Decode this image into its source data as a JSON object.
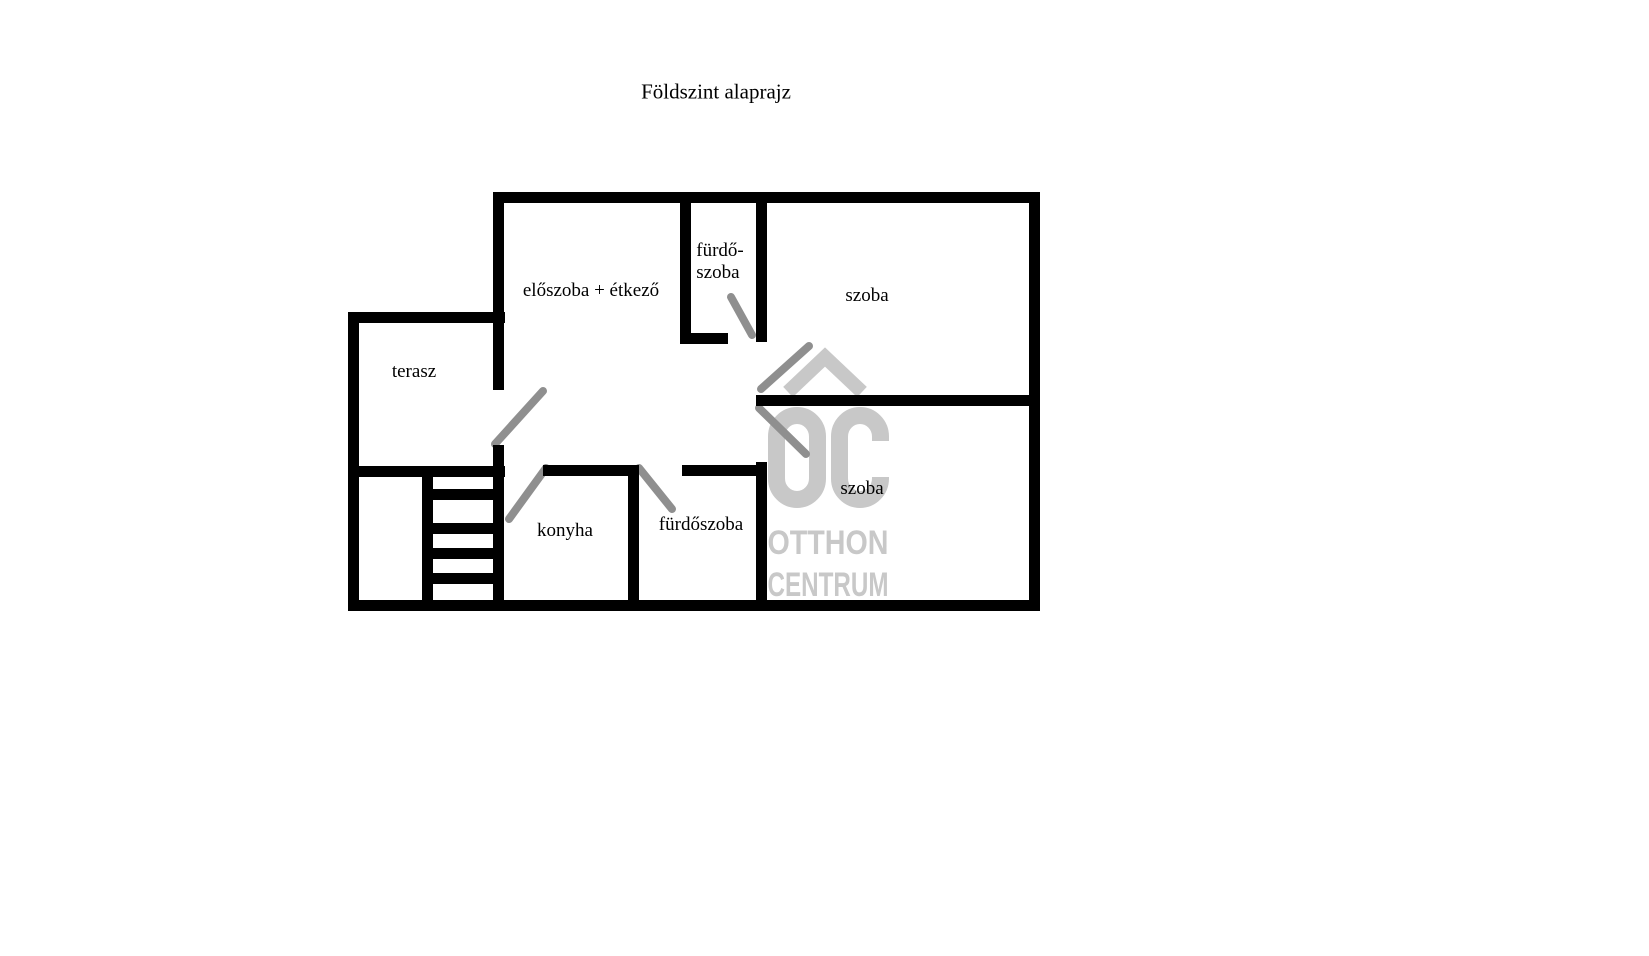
{
  "page": {
    "width": 1649,
    "height": 956,
    "background": "#ffffff"
  },
  "title": {
    "text": "Földszint alaprajz"
  },
  "floorplan": {
    "colors": {
      "wall": "#000000",
      "door": "#8f8f8f",
      "watermark": "#c8c8c8",
      "label": "#000000"
    },
    "labels": [
      {
        "id": "eloszoba-etkezo",
        "text": "előszoba + étkező",
        "cx": 591,
        "cy": 291
      },
      {
        "id": "furdoszoba-top",
        "text": "fürdő-\nszoba",
        "cx": 720,
        "cy": 262
      },
      {
        "id": "szoba-top",
        "text": "szoba",
        "cx": 867,
        "cy": 296
      },
      {
        "id": "terasz",
        "text": "terasz",
        "cx": 414,
        "cy": 372
      },
      {
        "id": "konyha",
        "text": "konyha",
        "cx": 565,
        "cy": 531
      },
      {
        "id": "furdoszoba-bottom",
        "text": "fürdőszoba",
        "cx": 701,
        "cy": 525
      },
      {
        "id": "szoba-bottom",
        "text": "szoba",
        "cx": 862,
        "cy": 489
      }
    ],
    "walls": [
      {
        "id": "top",
        "x": 493,
        "y": 192,
        "w": 547,
        "h": 11
      },
      {
        "id": "right",
        "x": 1029,
        "y": 192,
        "w": 11,
        "h": 419
      },
      {
        "id": "bottom",
        "x": 348,
        "y": 600,
        "w": 692,
        "h": 11
      },
      {
        "id": "outer-left",
        "x": 348,
        "y": 312,
        "w": 11,
        "h": 299
      },
      {
        "id": "terasz-top",
        "x": 348,
        "y": 312,
        "w": 157,
        "h": 11
      },
      {
        "id": "terasz-bottom",
        "x": 348,
        "y": 466,
        "w": 157,
        "h": 11
      },
      {
        "id": "hall-left-upper",
        "x": 493,
        "y": 192,
        "w": 11,
        "h": 198
      },
      {
        "id": "hall-left-lower",
        "x": 493,
        "y": 445,
        "w": 11,
        "h": 166
      },
      {
        "id": "stairs-left-rail",
        "x": 422,
        "y": 466,
        "w": 11,
        "h": 145
      },
      {
        "id": "konyha-top",
        "x": 543,
        "y": 465,
        "w": 96,
        "h": 11
      },
      {
        "id": "konyha-right",
        "x": 628,
        "y": 465,
        "w": 11,
        "h": 146
      },
      {
        "id": "bath-bottom-top",
        "x": 682,
        "y": 465,
        "w": 85,
        "h": 11
      },
      {
        "id": "bath-bottom-right",
        "x": 756,
        "y": 462,
        "w": 11,
        "h": 149
      },
      {
        "id": "bath-top-left",
        "x": 680,
        "y": 192,
        "w": 11,
        "h": 152
      },
      {
        "id": "bath-top-bottom",
        "x": 680,
        "y": 333,
        "w": 48,
        "h": 11
      },
      {
        "id": "bath-top-right",
        "x": 756,
        "y": 192,
        "w": 11,
        "h": 150
      },
      {
        "id": "middle",
        "x": 756,
        "y": 395,
        "w": 284,
        "h": 11
      }
    ],
    "stairs": {
      "treads": [
        {
          "x": 433,
          "y": 489,
          "w": 60,
          "h": 11
        },
        {
          "x": 433,
          "y": 523,
          "w": 60,
          "h": 11
        },
        {
          "x": 433,
          "y": 548,
          "w": 60,
          "h": 11
        },
        {
          "x": 433,
          "y": 573,
          "w": 60,
          "h": 11
        }
      ]
    },
    "doors": [
      {
        "id": "terasz-door",
        "x1": 495,
        "y1": 444,
        "x2": 543,
        "y2": 391
      },
      {
        "id": "konyha-door",
        "x1": 546,
        "y1": 468,
        "x2": 509,
        "y2": 519
      },
      {
        "id": "bath-bottom-door",
        "x1": 639,
        "y1": 468,
        "x2": 672,
        "y2": 509
      },
      {
        "id": "bath-top-door",
        "x1": 731,
        "y1": 297,
        "x2": 752,
        "y2": 335
      },
      {
        "id": "szoba-top-door",
        "x1": 761,
        "y1": 389,
        "x2": 809,
        "y2": 346
      },
      {
        "id": "szoba-bottom-door",
        "x1": 759,
        "y1": 408,
        "x2": 806,
        "y2": 454
      }
    ],
    "watermark": {
      "line1": "OTTHON",
      "line2": "CENTRUM"
    }
  }
}
